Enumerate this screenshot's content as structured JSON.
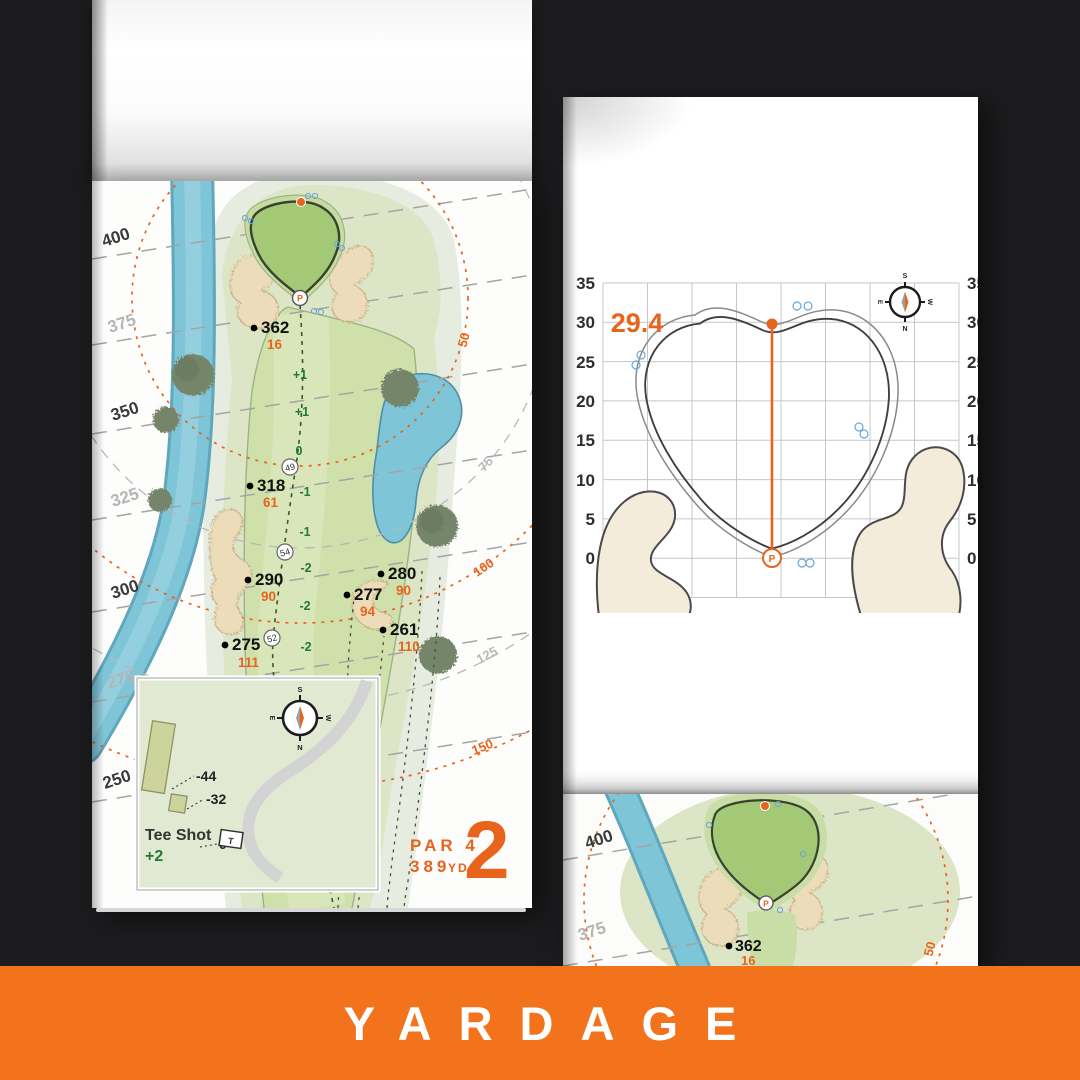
{
  "banner": {
    "label": "YARDAGE"
  },
  "colors": {
    "accent_orange": "#E8641C",
    "banner_orange": "#F2731C",
    "slope_green": "#1F7A34",
    "water": "#7FC5D8",
    "sand": "#EDDCB9",
    "green_fill": "#A3C977",
    "fairway": "#CFE0AB"
  },
  "left_page": {
    "edge_labels": [
      {
        "text": "400",
        "tone": "dark"
      },
      {
        "text": "375",
        "tone": "light"
      },
      {
        "text": "350",
        "tone": "dark"
      },
      {
        "text": "325",
        "tone": "light"
      },
      {
        "text": "300",
        "tone": "dark"
      },
      {
        "text": "275",
        "tone": "light"
      },
      {
        "text": "250",
        "tone": "dark"
      }
    ],
    "arc_labels": [
      {
        "text": "50",
        "tone": "orange"
      },
      {
        "text": "75",
        "tone": "gray"
      },
      {
        "text": "100",
        "tone": "orange"
      },
      {
        "text": "125",
        "tone": "gray"
      },
      {
        "text": "150",
        "tone": "orange"
      }
    ],
    "carries": [
      {
        "carry": "362",
        "to_pin": "16"
      },
      {
        "carry": "318",
        "to_pin": "61"
      },
      {
        "carry": "290",
        "to_pin": "90"
      },
      {
        "carry": "275",
        "to_pin": "111"
      },
      {
        "carry": "280",
        "to_pin": "90"
      },
      {
        "carry": "277",
        "to_pin": "94"
      },
      {
        "carry": "261",
        "to_pin": "110"
      }
    ],
    "segments": [
      "49",
      "54",
      "52"
    ],
    "slopes": [
      "+1",
      "+1",
      "0",
      "-1",
      "-1",
      "-2",
      "-2",
      "-2",
      "-2",
      "-1",
      "-1",
      "-1",
      "0"
    ],
    "pin_letter": "P",
    "hole": {
      "par": "PAR 4",
      "yards": "389",
      "unit": "YD",
      "number": "2"
    },
    "tee_inset": {
      "title": "Tee Shot",
      "score": "+2",
      "left_offset": "-44",
      "right_offset": "-32",
      "tee_offset": "0",
      "tee_marker": "T"
    },
    "compass": {
      "n": "N",
      "s": "S",
      "e": "E",
      "w": "W"
    }
  },
  "right_page": {
    "green_plot": {
      "measurement": "29.4",
      "axis_ticks": [
        "35",
        "30",
        "25",
        "20",
        "15",
        "10",
        "5",
        "0"
      ],
      "pin_letter": "P",
      "compass": {
        "n": "N",
        "s": "S",
        "e": "E",
        "w": "W"
      }
    },
    "next_page": {
      "label_400": "400",
      "label_375": "375",
      "carry": "362",
      "to_pin": "16",
      "arc_label": "50",
      "pin_letter": "P"
    }
  },
  "chart_data": {
    "type": "line",
    "title": "Green depth plot",
    "xlabel": "",
    "ylabel": "yards",
    "ylim": [
      0,
      35
    ],
    "tick_step": 5,
    "series": [
      {
        "name": "pin-to-back-measurement",
        "values": [
          0,
          29.4
        ]
      }
    ],
    "annotations": [
      "29.4"
    ]
  }
}
